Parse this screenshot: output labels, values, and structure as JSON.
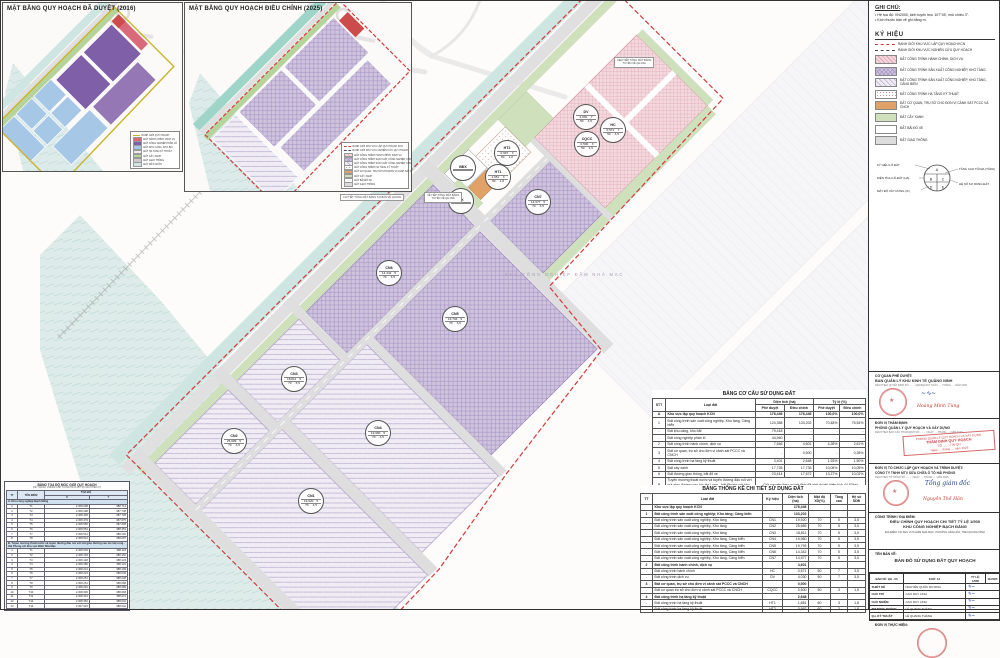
{
  "notes": {
    "title": "GHI CHÚ:",
    "items": [
      "• Hệ tọa độ: VN2000, kinh tuyến trục 107°45', múi chiếu 3°.",
      "• Kích thước bản vẽ ghi bằng m."
    ]
  },
  "legend": {
    "title": "KÝ HIỆU",
    "items": [
      {
        "swatch": "sw-b1",
        "label": "RANH GIỚI KHU VỰC LẬP QUY HOẠCH KCN"
      },
      {
        "swatch": "sw-b2",
        "label": "RANH GIỚI KHU VỰC NGHIÊN CỨU QUY HOẠCH"
      },
      {
        "swatch": "sw-hc",
        "label": "ĐẤT CÔNG TRÌNH HÀNH CHÍNH, DỊCH VỤ"
      },
      {
        "swatch": "sw-cn",
        "label": "ĐẤT CÔNG TRÌNH SẢN XUẤT CÔNG NGHIỆP, KHO TÀNG"
      },
      {
        "swatch": "sw-cncb",
        "label": "ĐẤT CÔNG TRÌNH SẢN XUẤT CÔNG NGHIỆP, KHO TÀNG, CẢNG BIỂN"
      },
      {
        "swatch": "sw-ht",
        "label": "ĐẤT CÔNG TRÌNH HẠ TẦNG KỸ THUẬT"
      },
      {
        "swatch": "sw-cqcc",
        "label": "ĐẤT CƠ QUAN, TRỤ SỞ CHO ĐƠN VỊ CẢNH SÁT PCCC VÀ CNCH"
      },
      {
        "swatch": "sw-cx",
        "label": "ĐẤT CÂY XANH"
      },
      {
        "swatch": "sw-bdx",
        "label": "ĐẤT BÃI ĐỖ XE"
      },
      {
        "swatch": "sw-gt",
        "label": "ĐẤT GIAO THÔNG"
      }
    ],
    "diagram": {
      "left_labels": [
        "KÝ HIỆU LÔ ĐẤT",
        "DIỆN TÍCH LÔ ĐẤT (HA)",
        "MẬT ĐỘ XÂY DỰNG (%)"
      ],
      "right_labels": [
        "TẦNG CAO TỐI ĐA (TẦNG)",
        "HỆ SỐ SỬ DỤNG ĐẤT"
      ],
      "letters": {
        "a": "A",
        "b": "B",
        "c": "C",
        "d": "D",
        "e": "E"
      }
    }
  },
  "insets": {
    "title_2016": "MẶT BẰNG QUY HOẠCH ĐÃ DUYỆT (2016)",
    "title_2025": "MẶT BẰNG QUY HOẠCH ĐIỀU CHỈNH (2025)",
    "note_2025": "CHI TIẾT TỔNG MẶT BẰNG TẠI BẢN VẼ QH-03A",
    "legend_2016": [
      {
        "c": "s16-b",
        "t": "RANH GIỚI QUY HOẠCH"
      },
      {
        "c": "s16-hc",
        "t": "ĐẤT HÀNH CHÍNH, DỊCH VỤ"
      },
      {
        "c": "s16-cn",
        "t": "ĐẤT CÔNG NGHIỆP PHÂN LÔ"
      },
      {
        "c": "s16-cang",
        "t": "ĐẤT KHU CẢNG, KHO BÃI"
      },
      {
        "c": "s16-ht",
        "t": "ĐẤT HẠ TẦNG KỸ THUẬT"
      },
      {
        "c": "s16-cx",
        "t": "ĐẤT CÂY XANH"
      },
      {
        "c": "s16-gt",
        "t": "ĐẤT GIAO THÔNG"
      },
      {
        "c": "s16-mn",
        "t": "ĐẤT MẶT NƯỚC"
      }
    ]
  },
  "map": {
    "background_label": "KHU CÔNG NGHIỆP ĐẦM NHÀ MẠC",
    "callouts": [
      {
        "x": 614,
        "y": 57,
        "l1": "XEM TIẾP TỔNG MẶT BẰNG",
        "l2": "TUYẾN VỀ QH-03A"
      },
      {
        "x": 424,
        "y": 192,
        "l1": "VỀ TIẾP TỔNG MẶT BẰNG",
        "l2": "TUYẾN VỀ QH-03A"
      }
    ],
    "lots": [
      {
        "x": 585,
        "y": 116,
        "sym": "DV",
        "a": "4,030",
        "f": "7",
        "d": "50",
        "k": "3,5"
      },
      {
        "x": 612,
        "y": 129,
        "sym": "HC",
        "a": "0,571",
        "f": "7",
        "d": "50",
        "k": "3,5"
      },
      {
        "x": 586,
        "y": 143,
        "sym": "CQCC",
        "a": "0,500",
        "f": "3",
        "d": "50",
        "k": "1,5"
      },
      {
        "x": 506,
        "y": 152,
        "sym": "HT2",
        "a": "0,997",
        "f": "3",
        "d": "60",
        "k": "1,8"
      },
      {
        "x": 497,
        "y": 176,
        "sym": "HT1",
        "a": "1,651",
        "f": "3",
        "d": "60",
        "k": "1,8"
      },
      {
        "x": 462,
        "y": 167,
        "sym": "BĐX",
        "a": "",
        "f": "",
        "d": "",
        "k": ""
      },
      {
        "x": 460,
        "y": 200,
        "sym": "CX",
        "a": "",
        "f": "",
        "d": "",
        "k": ""
      },
      {
        "x": 537,
        "y": 201,
        "sym": "CN7",
        "a": "14,977",
        "f": "5",
        "d": "70",
        "k": "3,5"
      },
      {
        "x": 388,
        "y": 272,
        "sym": "CN6",
        "a": "14,342",
        "f": "5",
        "d": "70",
        "k": "3,5"
      },
      {
        "x": 454,
        "y": 318,
        "sym": "CN5",
        "a": "19,793",
        "f": "5",
        "d": "70",
        "k": "3,5"
      },
      {
        "x": 293,
        "y": 378,
        "sym": "CN3",
        "a": "18,811",
        "f": "5",
        "d": "70",
        "k": "3,5"
      },
      {
        "x": 377,
        "y": 432,
        "sym": "CN4",
        "a": "19,960",
        "f": "5",
        "d": "70",
        "k": "3,5"
      },
      {
        "x": 233,
        "y": 440,
        "sym": "CN2",
        "a": "25,689",
        "f": "5",
        "d": "70",
        "k": "3,5"
      },
      {
        "x": 310,
        "y": 500,
        "sym": "CN1",
        "a": "19,920",
        "f": "5",
        "d": "70",
        "k": "3,5"
      }
    ]
  },
  "table_structure": {
    "title": "BẢNG CƠ CẤU SỬ DỤNG ĐẤT",
    "h_stt": "STT",
    "h_loai": "Loại đất",
    "h_dt": "Diện tích (ha)",
    "h_tl": "Tỷ lệ (%)",
    "h_pd": "Phê duyệt",
    "h_dc": "Điều chỉnh",
    "rows": [
      {
        "stt": "A",
        "label": "Khu vực lập quy hoạch KCN",
        "d1": "176,446",
        "d2": "176,446",
        "t1": "100,0%",
        "t2": "100,0%",
        "cls": "grp"
      },
      {
        "stt": "1",
        "label": "Đất công trình sản xuất công nghiệp, Kho tàng, Cảng biển",
        "d1": "124,358",
        "d2": "133,202",
        "t1": "70,48%",
        "t2": "75,54%"
      },
      {
        "stt": "-",
        "label": "Đất khu cảng, kho bãi",
        "d1": "79,418",
        "d2": "-",
        "t1": "-",
        "t2": "-"
      },
      {
        "stt": "-",
        "label": "Đất công nghiệp phân lô",
        "d1": "44,940",
        "d2": "-",
        "t1": "-",
        "t2": "-"
      },
      {
        "stt": "2",
        "label": "Đất công trình hành chính, dịch vụ",
        "d1": "7,546",
        "d2": "4,601",
        "t1": "4,28%",
        "t2": "2,61%"
      },
      {
        "stt": "3",
        "label": "Đất cơ quan, trụ sở cho đơn vị cảnh sát PCCC và CNCH",
        "d1": "-",
        "d2": "0,500",
        "t1": "-",
        "t2": "0,28%"
      },
      {
        "stt": "4",
        "label": "Đất công trình hạ tầng kỹ thuật",
        "d1": "3,401",
        "d2": "2,648",
        "t1": "1,93%",
        "t2": "1,50%"
      },
      {
        "stt": "5",
        "label": "Đất cây xanh",
        "d1": "17,728",
        "d2": "17,733",
        "t1": "10,05%",
        "t2": "10,05%"
      },
      {
        "stt": "6",
        "label": "Đất đường giao thông, bãi đỗ xe",
        "d1": "23,414",
        "d2": "17,672",
        "t1": "13,27%",
        "t2": "10,02%"
      }
    ],
    "row_b_stt": "B",
    "row_b_label": "Tuyến mương thoát nước và tuyến đường đấu nối với nút giao đường cao tốc Hạ Long - Hải Phòng với khu vực Đầm Nhà Mạc",
    "row_b_note": "Giữ nguyên theo quyết định đã phê duyệt (diện tích 44,63ha)"
  },
  "table_detail": {
    "title": "BẢNG THỐNG KÊ CHI TIẾT SỬ DỤNG ĐẤT",
    "h_tt": "TT",
    "h_loai": "Loại đất",
    "h_kh": "Ký hiệu",
    "h_dt": "Diện tích (ha)",
    "h_md": "Mật độ XD(%)",
    "h_tc": "Tầng cao",
    "h_hs": "Hệ số SDĐ",
    "rows": [
      {
        "tt": "",
        "label": "Khu vực lập quy hoạch KCN",
        "kh": "",
        "a": "176,446",
        "d": "",
        "f": "",
        "k": "",
        "cls": "grp"
      },
      {
        "tt": "1",
        "label": "Đất công trình sản xuất công nghiệp; Kho tàng; Cảng biển",
        "kh": "",
        "a": "133,202",
        "d": "",
        "f": "",
        "k": "",
        "cls": "grp"
      },
      {
        "tt": "-",
        "label": "Đất công trình sản xuất công nghiệp, Kho tàng",
        "kh": "CN1",
        "a": "19,920",
        "d": "70",
        "f": "5",
        "k": "3,5"
      },
      {
        "tt": "-",
        "label": "Đất công trình sản xuất công nghiệp, Kho tàng",
        "kh": "CN2",
        "a": "25,689",
        "d": "70",
        "f": "5",
        "k": "3,5"
      },
      {
        "tt": "-",
        "label": "Đất công trình sản xuất công nghiệp, Kho tàng",
        "kh": "CN3",
        "a": "18,811",
        "d": "70",
        "f": "5",
        "k": "3,5"
      },
      {
        "tt": "-",
        "label": "Đất công trình sản xuất công nghiệp, Kho tàng, Cảng biển",
        "kh": "CN4",
        "a": "19,960",
        "d": "70",
        "f": "5",
        "k": "3,5"
      },
      {
        "tt": "-",
        "label": "Đất công trình sản xuất công nghiệp, Kho tàng, Cảng biển",
        "kh": "CN5",
        "a": "19,793",
        "d": "70",
        "f": "5",
        "k": "3,5"
      },
      {
        "tt": "-",
        "label": "Đất công trình sản xuất công nghiệp, Kho tàng, Cảng biển",
        "kh": "CN6",
        "a": "14,342",
        "d": "70",
        "f": "5",
        "k": "3,5"
      },
      {
        "tt": "-",
        "label": "Đất công trình sản xuất công nghiệp, Kho tàng, Cảng biển",
        "kh": "CN7",
        "a": "14,977",
        "d": "70",
        "f": "5",
        "k": "3,5"
      },
      {
        "tt": "2",
        "label": "Đất công trình hành chính, dịch vụ",
        "kh": "",
        "a": "4,601",
        "d": "",
        "f": "",
        "k": "",
        "cls": "grp"
      },
      {
        "tt": "-",
        "label": "Đất công trình hành chính",
        "kh": "HC",
        "a": "0,571",
        "d": "50",
        "f": "7",
        "k": "3,5"
      },
      {
        "tt": "-",
        "label": "Đất công trình dịch vụ",
        "kh": "DV",
        "a": "4,030",
        "d": "50",
        "f": "7",
        "k": "3,5"
      },
      {
        "tt": "3",
        "label": "Đất cơ quan, trụ sở cho đơn vị cảnh sát PCCC và CNCH",
        "kh": "",
        "a": "0,500",
        "d": "",
        "f": "",
        "k": "",
        "cls": "grp"
      },
      {
        "tt": "-",
        "label": "Đất cơ quan trụ sở cho đơn vị cảnh sát PCCC và CNCH",
        "kh": "CQCC",
        "a": "0,500",
        "d": "50",
        "f": "3",
        "k": "1,5"
      },
      {
        "tt": "4",
        "label": "Đất công trình hạ tầng kỹ thuật",
        "kh": "",
        "a": "2,648",
        "d": "",
        "f": "",
        "k": "",
        "cls": "grp"
      },
      {
        "tt": "-",
        "label": "Đất công trình hạ tầng kỹ thuật",
        "kh": "HT1",
        "a": "1,651",
        "d": "60",
        "f": "3",
        "k": "1,8"
      },
      {
        "tt": "-",
        "label": "Đất công trình hạ tầng kỹ thuật",
        "kh": "HT2",
        "a": "0,997",
        "d": "60",
        "f": "3",
        "k": "1,8"
      }
    ]
  },
  "coord_table": {
    "title": "BẢNG TỌA ĐỘ MỐC GIỚI QUY HOẠCH",
    "subtitle": "(HỆ TỌA ĐỘ VN2000 KINH TUYẾN TRỤC 107°45' MÚI CHIẾU 3°)",
    "h_tt": "TT",
    "h_ten": "TÊN ĐIỂM",
    "h_toado": "TỌA ĐỘ",
    "h_x": "X",
    "h_y": "Y",
    "section_a": "A. Khu công nghiệp Bạch Đằng",
    "rows_a": [
      {
        "tt": "1",
        "ten": "T1",
        "x": "2.308.608",
        "y": "388.714"
      },
      {
        "tt": "2",
        "ten": "T2",
        "x": "2.308.498",
        "y": "387.738"
      },
      {
        "tt": "3",
        "ten": "T3",
        "x": "2.308.406",
        "y": "387.728"
      },
      {
        "tt": "4",
        "ten": "T4",
        "x": "2.308.479",
        "y": "387.675"
      },
      {
        "tt": "5",
        "ten": "T5",
        "x": "2.308.566",
        "y": "387.698"
      },
      {
        "tt": "6",
        "ten": "T6",
        "x": "2.308.554",
        "y": "388.354"
      },
      {
        "tt": "7",
        "ten": "T7",
        "x": "2.308.512",
        "y": "388.292"
      },
      {
        "tt": "8",
        "ten": "T8",
        "x": "2.308.512",
        "y": "388.087"
      }
    ],
    "section_b": "B. Tuyến mương thoát nước và tuyến đường đấu nối với nút giao đường cao tốc Hạ Long - Hải Phòng với khu vực Đầm Nhà Mạc",
    "rows_b": [
      {
        "tt": "1",
        "ten": "T1",
        "x": "2.308.603",
        "y": "388.118"
      },
      {
        "tt": "2",
        "ten": "T2",
        "x": "2.308.139",
        "y": "388.152"
      },
      {
        "tt": "3",
        "ten": "T3",
        "x": "2.308.148",
        "y": "388.133"
      },
      {
        "tt": "4",
        "ten": "T4",
        "x": "2.308.180",
        "y": "388.124"
      },
      {
        "tt": "5",
        "ten": "T5",
        "x": "2.308.214",
        "y": "388.109"
      },
      {
        "tt": "6",
        "ten": "T6",
        "x": "2.308.223",
        "y": "388.046"
      },
      {
        "tt": "7",
        "ten": "T7",
        "x": "2.308.251",
        "y": "388.048"
      },
      {
        "tt": "8",
        "ten": "T8",
        "x": "2.308.261",
        "y": "388.088"
      },
      {
        "tt": "9",
        "ten": "T9",
        "x": "2.308.291",
        "y": "388.089"
      },
      {
        "tt": "10",
        "ten": "T10",
        "x": "2.308.306",
        "y": "388.068"
      },
      {
        "tt": "11",
        "ten": "T11",
        "x": "2.308.331",
        "y": "388.072"
      },
      {
        "tt": "12",
        "ten": "T12",
        "x": "2.308.352",
        "y": "388.042"
      },
      {
        "tt": "13",
        "ten": "T13",
        "x": "2.307.915",
        "y": "388.042"
      }
    ]
  },
  "titleblock": {
    "b1_h": "CƠ QUAN PHÊ DUYỆT:",
    "b1_org": "BAN QUẢN LÝ KHU KINH TẾ QUẢNG NINH",
    "b1_note": "KÈM THEO QUYẾT ĐỊNH SỐ: ......../QĐ-BQLKKT NGÀY .... THÁNG .... NĂM 2025",
    "b1_name": "Hoàng Minh Tùng",
    "b2_h": "ĐƠN VỊ THẨM ĐỊNH:",
    "b2_org": "PHÒNG QUẢN LÝ QUY HOẠCH VÀ XÂY DỰNG",
    "b2_note": "KÈM THEO BÁO CÁO THẨM ĐỊNH SỐ: ........ NGÀY .... THÁNG .... NĂM 2025",
    "b2_stamp_small": "PHÒNG QUẢN LÝ QUY HOẠCH VÀ XÂY DỰNG",
    "b2_stamp_main": "THẨM ĐỊNH QUY HOẠCH",
    "b2_stamp_l1": "SỐ: ......../TĐ-QH",
    "b2_stamp_l2": "Ngày .... tháng .... năm 2025",
    "b3_h": "ĐƠN VỊ TỔ CHỨC LẬP QUY HOẠCH VÀ TRÌNH DUYỆT:",
    "b3_org": "CÔNG TY TNHH MTV SỬA CHỮA Ô TÔ HẢI PHÒNG",
    "b3_note": "KÈM THEO TỜ TRÌNH SỐ: ........ NGÀY .... THÁNG .... NĂM 2025",
    "b3_sig": "Tổng giám đốc",
    "b3_name": "Nguyễn Thế Hân",
    "b4_h": "CÔNG TRÌNH / ĐỊA ĐIỂM:",
    "b4_l1": "ĐIỀU CHỈNH QUY HOẠCH CHI TIẾT TỶ LỆ 1/500",
    "b4_l2": "KHU CÔNG NGHIỆP BẠCH ĐẰNG",
    "b4_l3": "ĐỊA ĐIỂM: TẠI KHU VỰC ĐẦM NHÀ MẠC, PHƯỜNG LIÊN HÒA, TỈNH QUẢNG NINH",
    "b5_h": "TÊN BẢN VẼ:",
    "b5_title": "BẢN ĐỒ SỬ DỤNG ĐẤT QUY HOẠCH",
    "meta": [
      "BẢN VẼ: QH - 03",
      "KHỔ: A1",
      "TỶ LỆ: 1/500",
      "11/2025"
    ],
    "roles": [
      {
        "role": "THIẾT KẾ",
        "name": "NGUYỄN QUỐC DƯƠNG"
      },
      {
        "role": "CHỦ TRÌ",
        "name": "CAO DUY LINH"
      },
      {
        "role": "CHỦ NHIỆM",
        "name": "CAO DUY LINH"
      },
      {
        "role": "TRƯỞNG PHÒNG",
        "name": "LÊ QUANG THÀNH"
      },
      {
        "role": "Q.L KỸ THUẬT",
        "name": "LÊ QUANG THÀNH"
      }
    ],
    "b7_h": "ĐƠN VỊ THỰC HIỆN:"
  }
}
